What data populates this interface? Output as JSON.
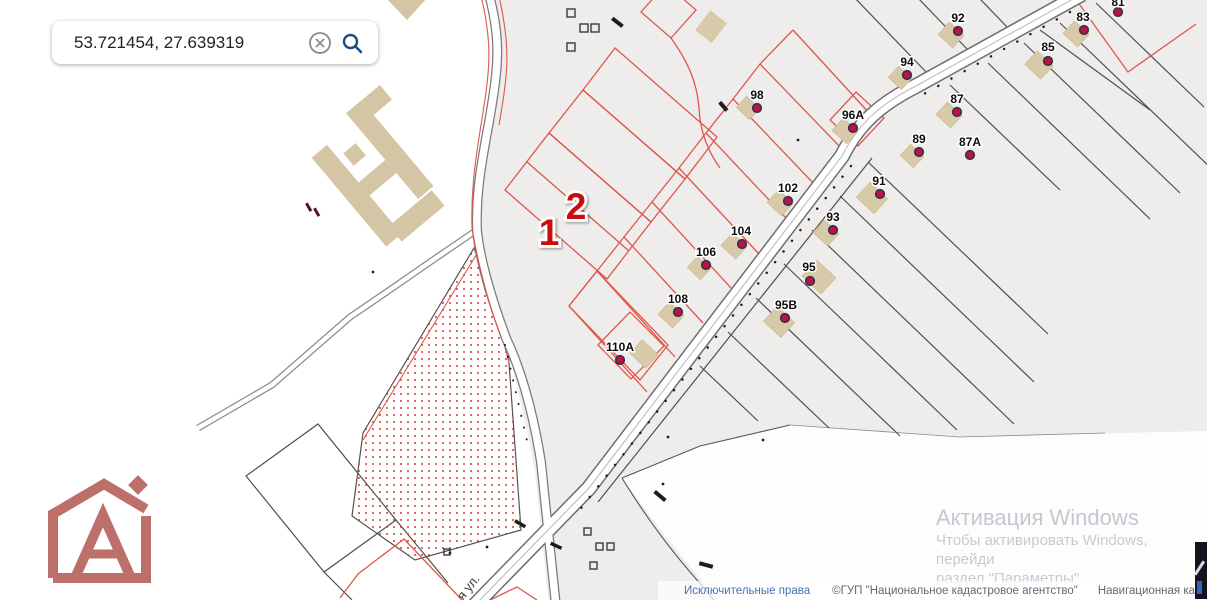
{
  "search": {
    "value": "53.721454, 27.639319"
  },
  "map": {
    "street_label": "я ул.",
    "selection_markers": [
      {
        "label": "1",
        "x": 549,
        "y": 245
      },
      {
        "label": "2",
        "x": 576,
        "y": 219
      }
    ],
    "houses": [
      {
        "label": "92",
        "lx": 958,
        "ly": 22,
        "mx": 958,
        "my": 31,
        "bx": 951,
        "by": 35,
        "bs": 20
      },
      {
        "label": "94",
        "lx": 907,
        "ly": 66,
        "mx": 907,
        "my": 75,
        "bx": 900,
        "by": 78,
        "bs": 18
      },
      {
        "label": "98",
        "lx": 757,
        "ly": 99,
        "mx": 757,
        "my": 108,
        "bx": 748,
        "by": 108,
        "bs": 18
      },
      {
        "label": "96A",
        "lx": 853,
        "ly": 119,
        "mx": 853,
        "my": 128,
        "bx": 845,
        "by": 131,
        "bs": 20
      },
      {
        "label": "85",
        "lx": 1048,
        "ly": 51,
        "mx": 1048,
        "my": 61,
        "bx": 1039,
        "by": 65,
        "bs": 22
      },
      {
        "label": "87",
        "lx": 957,
        "ly": 103,
        "mx": 957,
        "my": 112,
        "bx": 949,
        "by": 115,
        "bs": 20
      },
      {
        "label": "89",
        "lx": 919,
        "ly": 143,
        "mx": 919,
        "my": 152,
        "bx": 912,
        "by": 156,
        "bs": 18
      },
      {
        "label": "87A",
        "lx": 970,
        "ly": 146,
        "mx": 970,
        "my": 155,
        "bx": null,
        "by": null,
        "bs": null
      },
      {
        "label": "91",
        "lx": 879,
        "ly": 185,
        "mx": 880,
        "my": 194,
        "bx": 872,
        "by": 198,
        "bs": 24
      },
      {
        "label": "102",
        "lx": 788,
        "ly": 192,
        "mx": 788,
        "my": 201,
        "bx": 780,
        "by": 203,
        "bs": 20
      },
      {
        "label": "93",
        "lx": 833,
        "ly": 221,
        "mx": 833,
        "my": 230,
        "bx": 826,
        "by": 233,
        "bs": 20
      },
      {
        "label": "104",
        "lx": 741,
        "ly": 235,
        "mx": 742,
        "my": 244,
        "bx": 734,
        "by": 246,
        "bs": 20
      },
      {
        "label": "106",
        "lx": 706,
        "ly": 256,
        "mx": 706,
        "my": 265,
        "bx": 699,
        "by": 268,
        "bs": 18
      },
      {
        "label": "95",
        "lx": 809,
        "ly": 271,
        "mx": 810,
        "my": 281,
        "bx": 819,
        "by": 277,
        "bs": 26
      },
      {
        "label": "108",
        "lx": 678,
        "ly": 303,
        "mx": 678,
        "my": 312,
        "bx": 671,
        "by": 315,
        "bs": 20
      },
      {
        "label": "95B",
        "lx": 786,
        "ly": 309,
        "mx": 785,
        "my": 318,
        "bx": 779,
        "by": 322,
        "bs": 24
      },
      {
        "label": "110A",
        "lx": 620,
        "ly": 351,
        "mx": 620,
        "my": 360,
        "bx": 644,
        "by": 354,
        "bs": 22
      },
      {
        "label": "83",
        "lx": 1083,
        "ly": 21,
        "mx": 1084,
        "my": 30,
        "bx": 1076,
        "by": 34,
        "bs": 20
      },
      {
        "label": "81",
        "lx": 1118,
        "ly": 6,
        "mx": 1118,
        "my": 12,
        "bx": null,
        "by": null,
        "bs": null
      }
    ]
  },
  "watermark": {
    "title": "Активация Windows",
    "line1": "Чтобы активировать Windows, перейди",
    "line2": "раздел \"Параметры\"."
  },
  "footer": {
    "link": "Исключительные права",
    "copyright": "©ГУП \"Национальное кадастровое агентство\"",
    "map_name": "Навигационная карта РБ"
  },
  "colors": {
    "parcel_red": "#e0564c",
    "parcel_dark": "#4f4f4f",
    "building": "#d8c9a8",
    "marker": "#c11045",
    "selection": "#c90f0f",
    "logo": "#bd6f6a",
    "search_icon": "#1a4f86"
  }
}
